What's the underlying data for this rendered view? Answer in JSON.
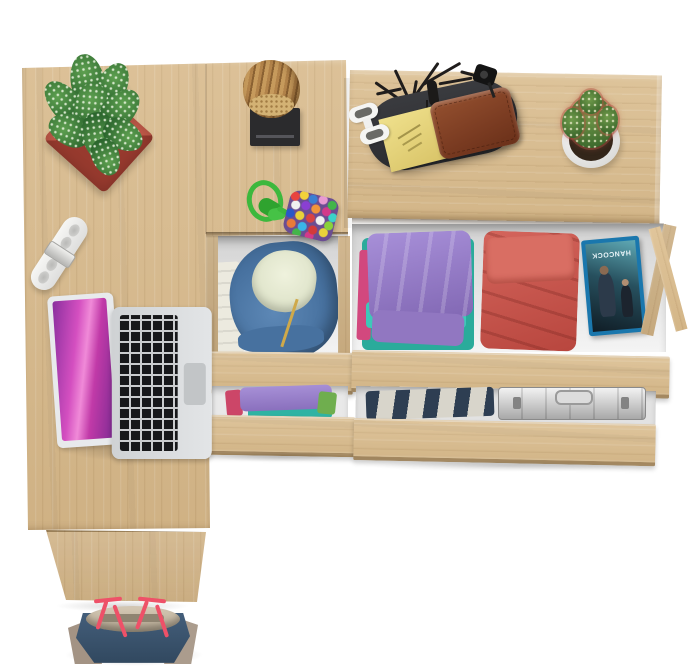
{
  "scene": {
    "description": "Top-down 3D product render: light sonoma-oak desk with side return, a two-drawer pedestal and a wide two-drawer dresser, drawers pulled open showing folded clothes; laptop, potted plants and accessories on top; white background",
    "background_color": "#ffffff"
  },
  "palette": {
    "oak": "#d8ba8c",
    "oak_edge_dark": "#5e421c",
    "drawer_interior": "#efefef",
    "plant_pot_red": "#b5473a",
    "plant_green": "#3c7a3c",
    "log_tan": "#b2834a",
    "stand_black": "#2b2b2d",
    "rope_green": "#3db83d",
    "hinge_white": "#f4f4f2",
    "laptop_silver": "#d6d8da",
    "laptop_screen_pink": "#d44fc0",
    "hoodie_blue": "#47719f",
    "hood_lining_cream": "#eff2dd",
    "clothes_purple": "#9a80cc",
    "clothes_teal": "#2fb3a3",
    "clothes_pink": "#d2487e",
    "clothes_red": "#c9544a",
    "dvd_case_blue": "#1a77ad",
    "briefcase_silver": "#c9c9c9",
    "tray_black": "#35363a",
    "wallet_brown": "#7d4028",
    "note_yellow": "#e5d67c",
    "cactus_pot_white": "#f2f2f0",
    "bag_navy": "#3e5a77",
    "bag_taupe": "#a39384",
    "bag_strap_red": "#ee5168"
  },
  "objects": {
    "desk": {
      "name": "oak corner desk with side return panel"
    },
    "pedestal": {
      "name": "narrow pedestal, two open drawers (blue hoodie; purple and teal clothes)"
    },
    "dresser": {
      "name": "wide dresser, two open drawers (folded clothes, DVD, aluminium briefcase)"
    },
    "laptop": {
      "name": "open silver laptop with pink wallpaper"
    },
    "plant": {
      "name": "speckled succulent in square red pot"
    },
    "log_ornament": {
      "name": "wooden log decor on black stand"
    },
    "keychain": {
      "name": "pom-pom pouch with green rope loop"
    },
    "hinge": {
      "name": "white furniture hinge"
    },
    "valet_tray": {
      "name": "black valet tray with sticky note, leather wallet, sunglasses, antler jewelry stand, key fob"
    },
    "cactus": {
      "name": "red-spined cactus in round white pot"
    },
    "hoodie": {
      "name": "blue zip hoodie with cream lining"
    },
    "dvd": {
      "title": "HANCOCK"
    },
    "briefcase": {
      "name": "aluminium briefcase"
    },
    "tote_bag": {
      "name": "navy tote bag with taupe sides and red straps"
    }
  }
}
